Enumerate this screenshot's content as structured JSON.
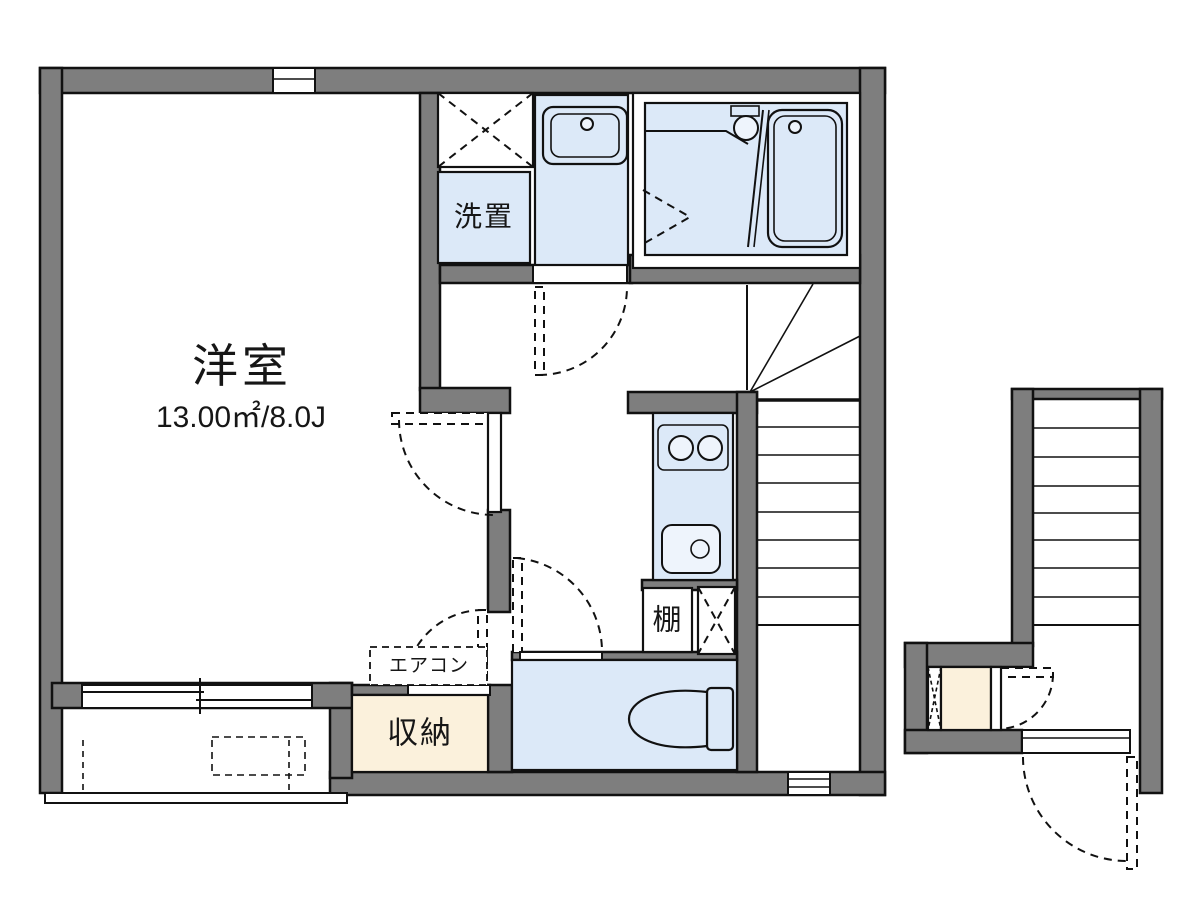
{
  "floorplan": {
    "labels": {
      "main_room_name": "洋室",
      "main_room_size": "13.00㎡/8.0J",
      "laundry": "洗置",
      "shelf": "棚",
      "aircon": "エアコン",
      "storage": "収納"
    },
    "colors": {
      "wall": "#7e7e7e",
      "wet_area_floor": "#dce9f8",
      "storage_floor": "#fbf1dc",
      "outline": "#111111",
      "background": "#ffffff"
    }
  }
}
